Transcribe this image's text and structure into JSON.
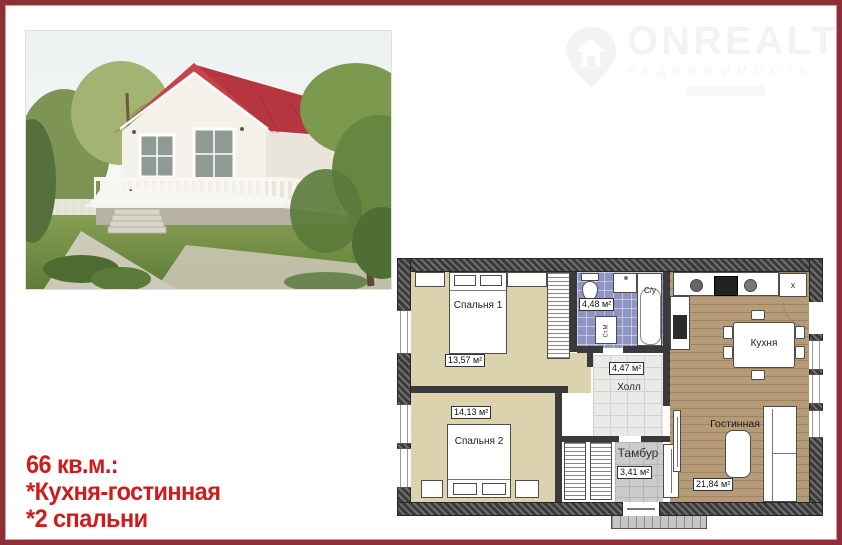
{
  "frame": {
    "border_color": "#8e2f37"
  },
  "watermark": {
    "brand": "ONREALT",
    "tagline": "НЕДВИЖИМОСТЬ"
  },
  "features": {
    "title": "66 кв.м.:",
    "items": [
      "*Кухня-гостинная",
      "*2 спальни"
    ]
  },
  "floorplan": {
    "rooms": [
      {
        "name": "Спальня 1",
        "area": "13,57 м²"
      },
      {
        "name": "С/у",
        "area": "4,48 м²"
      },
      {
        "name": "Кухня"
      },
      {
        "name": "Холл",
        "area": "4,47 м²"
      },
      {
        "name": "Спальня 2",
        "area": "14,13 м²"
      },
      {
        "name": "Тамбур",
        "area": "3,41 м²"
      },
      {
        "name": "Гостинная",
        "area": "21,84 м²"
      }
    ],
    "appliances": {
      "washing_machine": "Ст.М",
      "fridge_mark": "x"
    }
  },
  "colors": {
    "accent_red": "#ce1c1c",
    "frame": "#8e2f37",
    "bath_tile": "#8f94c2",
    "bedroom_floor": "#dad3ad",
    "wood_floor": "#b69b78"
  }
}
